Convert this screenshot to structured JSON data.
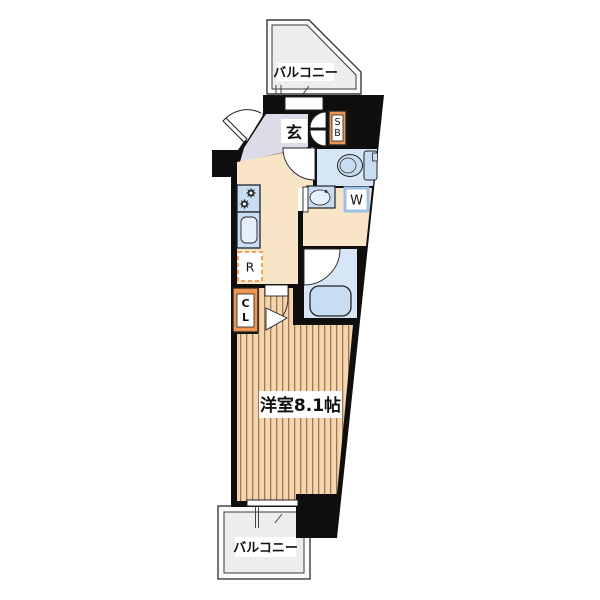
{
  "floorplan": {
    "balcony_top": {
      "label": "バルコニー"
    },
    "balcony_bottom": {
      "label": "バルコニー"
    },
    "entrance": {
      "label": "玄"
    },
    "shoe_box": {
      "line1": "S",
      "line2": "B"
    },
    "washing_machine": {
      "label": "W"
    },
    "refrigerator": {
      "label": "R"
    },
    "closet": {
      "line1": "C",
      "line2": "L"
    },
    "main_room": {
      "label": "洋室8.1帖"
    },
    "colors": {
      "wall": "#0f0f0f",
      "entrance_floor": "#dcdbe8",
      "hall_floor": "#f8e5c8",
      "wet_floor": "#d6e6f7",
      "fixture": "#c9ddf2",
      "fixture_light": "#e6f0fa",
      "accent_orange": "#ef9552",
      "wood": "#f6d5ae",
      "wood_line": "#8a6848",
      "balcony_fill": "#ededed",
      "white": "#ffffff"
    }
  }
}
